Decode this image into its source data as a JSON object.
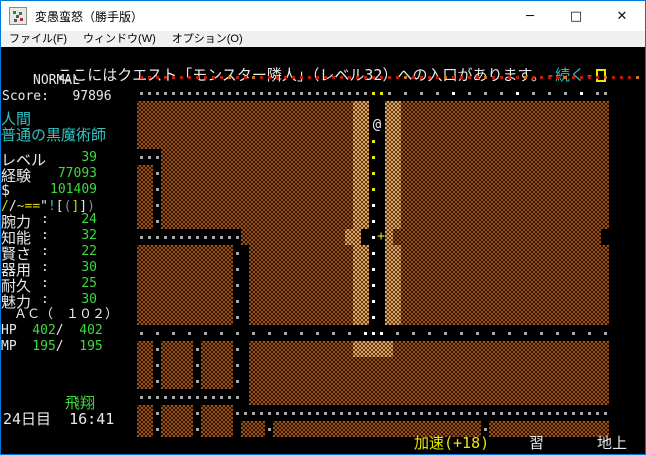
{
  "window": {
    "title": "変愚蛮怒（勝手版）",
    "controls": {
      "minimize": "─",
      "maximize": "□",
      "close": "✕"
    }
  },
  "menu": {
    "items": [
      {
        "label": "ファイル(F)"
      },
      {
        "label": "ウィンドウ(W)"
      },
      {
        "label": "オプション(O)"
      }
    ]
  },
  "message": {
    "text": "ここにはクエスト「モンスター隣人」（レベル32）への入口があります。",
    "more": "-続く-"
  },
  "status_top": {
    "mode": "NORMAL",
    "score_line": "Score:   97896"
  },
  "sidebar": {
    "race": "人間",
    "class": "普通の黒魔術師",
    "info_rows": [
      {
        "label": "レベル",
        "value": "39"
      },
      {
        "label": "経験",
        "value": "77093"
      },
      {
        "label": " $",
        "value": "101409"
      }
    ],
    "equipment_chars": [
      {
        "ch": "/",
        "color": "#d8d800"
      },
      {
        "ch": "/",
        "color": "#e9e9e9"
      },
      {
        "ch": "~",
        "color": "#d8d800"
      },
      {
        "ch": "=",
        "color": "#d8d800"
      },
      {
        "ch": "=",
        "color": "#d8d800"
      },
      {
        "ch": "\"",
        "color": "#e9e9e9"
      },
      {
        "ch": "!",
        "color": "#2fc4c4"
      },
      {
        "ch": "[",
        "color": "#e9e9e9"
      },
      {
        "ch": "(",
        "color": "#909090"
      },
      {
        "ch": "]",
        "color": "#d8d800"
      },
      {
        "ch": "]",
        "color": "#e9e9e9"
      },
      {
        "ch": ")",
        "color": "#909090"
      }
    ],
    "stats": [
      {
        "label": "腕力",
        "value": "24"
      },
      {
        "label": "知能",
        "value": "32"
      },
      {
        "label": "賢さ",
        "value": "22"
      },
      {
        "label": "器用",
        "value": "30"
      },
      {
        "label": "耐久",
        "value": "25"
      },
      {
        "label": "魅力",
        "value": "30"
      }
    ],
    "ac_line": "　ＡＣ（　１０２）",
    "hp": {
      "label": "HP",
      "cur": "  402",
      "slash": "/",
      "max": "  402"
    },
    "mp": {
      "label": "MP",
      "cur": "  195",
      "slash": "/",
      "max": "  195"
    },
    "state": "飛翔",
    "date_time": "24日目  16:41"
  },
  "status_bottom": {
    "speed": "加速(+18)",
    "study": "習",
    "depth": "地上"
  },
  "map": {
    "legend": {
      "#": "wall",
      "L": "lit-wall",
      ".": "floor-dot-gray",
      "w": "floor-dot-white",
      "y": "floor-dot-yellow",
      "r": "floor-dot-red",
      "o": "floor-dot-orange",
      "@": "player",
      "+": "door",
      " ": "dark"
    },
    "colors": {
      "wall_a": "#9a4f15",
      "wall_b": "#2f1505",
      "lit_a": "#d8a868",
      "lit_b": "#6b3a12",
      "dot_gray": "#a8a8a8",
      "dot_white": "#ffffff",
      "dot_yellow": "#e8e800",
      "dot_red": "#b42010",
      "dot_orange": "#c87828",
      "player": "#f0f0f0",
      "door": "#e8e800"
    },
    "rows": [
      "rrrrrrrrrrrorrorrrrrrrrrrrrrrrrrrorrrrorrrrorrrrorrrrorrrrorrro",
      ".............................yy. . . . w . . . w . . . w ..    ",
      "###########################LL  LL##########################    ",
      "###########################LL@ LL##########################    ",
      "###########################LLy LL##########################    ",
      "...########################LLy LL##########################    ",
      "##.########################LLy LL##########################    ",
      "##.########################LLy LL##########################    ",
      "##.########################LLw LL##########################    ",
      "##.########################LLw LL##########################    ",
      ".............#############LL w+L##########################    ",
      "############. #############LLw LL##########################    ",
      "############. #############LLw LL##########################    ",
      "############. #############LLw LL##########################    ",
      "############. #############LLw LL##########################    ",
      "############. #############LLw LL##########################    ",
      ". . . . . . . . . . . . . . www . . . . . . . . . . . . . .    ",
      "##.####.####. #############LLLLL###########################    ",
      "##.####.####. #############################################    ",
      "##.####.####. #############################################    ",
      "............. #############################################    ",
      "##.####.####...............................................    ",
      "##.####.#### ###.##########################.###############    "
    ]
  }
}
